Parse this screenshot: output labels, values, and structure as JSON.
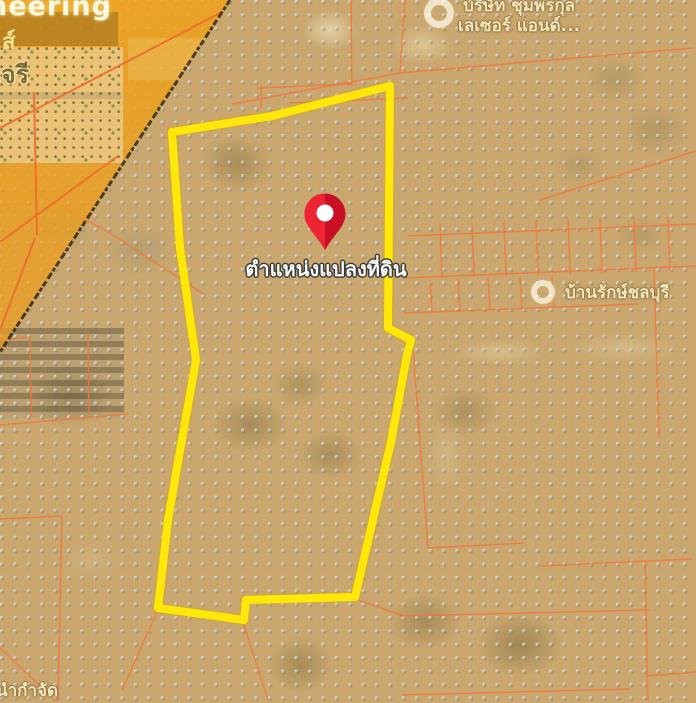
{
  "map": {
    "colors": {
      "map_base_tan": "#c9a76e",
      "overlay_orange": "#f2a314",
      "dot_grid": "#e4e0d7",
      "cadastral_line": "#f4763a",
      "cadastral_line_strong": "#ee6a2e",
      "parcel_yellow": "#ffe70a",
      "parcel_yellow_glow": "rgba(205,175,0,0.35)",
      "pin_red": "#c90f23",
      "pin_red_light": "#ee2433",
      "pin_hole": "#ffffff",
      "edge_dark": "rgba(32,30,22,0.78)"
    },
    "icons": {
      "pin": "location-pin",
      "poi_badge": "circle-badge"
    },
    "marker_label": "ตำแหน่งแปลงที่ดิน",
    "poi_top": {
      "line1": "บริษัท ชุมพรกุล",
      "line2": "เลเซอร์ แอนด์..."
    },
    "poi_right": {
      "label": "บ้านรักษ์ชลบุรี"
    },
    "edge_fragments": {
      "watermark_latin": "neering",
      "watermark_latin2": "ส์",
      "watermark_thai": "อจรี",
      "bottom_partial": "นำกำจัด"
    },
    "geometry": {
      "parcel_points": "172,132 272,116 390,86 388,328 411,340 407,355 391,442 355,597 246,600 244,620 158,608 168,520 177,468 196,360 180,248",
      "pin": {
        "x": 325,
        "y": 250
      },
      "overlay_edge": [
        230,
        0,
        0,
        352
      ],
      "cadastral_segments": [
        [
          405,
          0,
          400,
          73
        ],
        [
          351,
          0,
          352,
          85
        ],
        [
          232,
          104,
          400,
          73
        ],
        [
          258,
          88,
          352,
          84
        ],
        [
          261,
          86,
          261,
          108
        ],
        [
          290,
          103,
          408,
          98
        ],
        [
          400,
          73,
          692,
          48
        ],
        [
          540,
          200,
          696,
          151
        ],
        [
          404,
          278,
          696,
          266
        ],
        [
          408,
          236,
          696,
          224
        ],
        [
          404,
          313,
          638,
          304
        ],
        [
          440,
          224,
          442,
          278
        ],
        [
          472,
          222,
          474,
          277
        ],
        [
          504,
          221,
          506,
          276
        ],
        [
          536,
          220,
          538,
          275
        ],
        [
          568,
          219,
          570,
          274
        ],
        [
          600,
          218,
          602,
          273
        ],
        [
          634,
          217,
          636,
          272
        ],
        [
          668,
          216,
          670,
          271
        ],
        [
          430,
          280,
          432,
          312
        ],
        [
          458,
          279,
          460,
          311
        ],
        [
          488,
          278,
          490,
          310
        ],
        [
          520,
          277,
          522,
          309
        ],
        [
          552,
          276,
          554,
          308
        ],
        [
          654,
          270,
          659,
          438
        ],
        [
          413,
          348,
          428,
          548
        ],
        [
          428,
          548,
          524,
          543
        ],
        [
          400,
          616,
          650,
          610
        ],
        [
          645,
          560,
          648,
          700
        ],
        [
          540,
          566,
          692,
          559
        ],
        [
          646,
          676,
          696,
          672
        ],
        [
          402,
          695,
          630,
          689
        ],
        [
          355,
          599,
          402,
          615
        ],
        [
          158,
          610,
          122,
          690
        ],
        [
          243,
          622,
          268,
          700
        ],
        [
          0,
          425,
          128,
          414
        ],
        [
          30,
          336,
          31,
          417
        ],
        [
          88,
          333,
          89,
          415
        ],
        [
          0,
          340,
          28,
          337
        ],
        [
          0,
          519,
          62,
          516
        ],
        [
          62,
          516,
          58,
          700
        ],
        [
          0,
          648,
          55,
          700
        ],
        [
          25,
          187,
          110,
          233
        ],
        [
          110,
          233,
          205,
          295
        ]
      ],
      "overlay_segments": [
        [
          0,
          128,
          222,
          12
        ],
        [
          0,
          242,
          118,
          156
        ],
        [
          34,
          92,
          37,
          235
        ],
        [
          0,
          330,
          35,
          238
        ]
      ]
    }
  }
}
